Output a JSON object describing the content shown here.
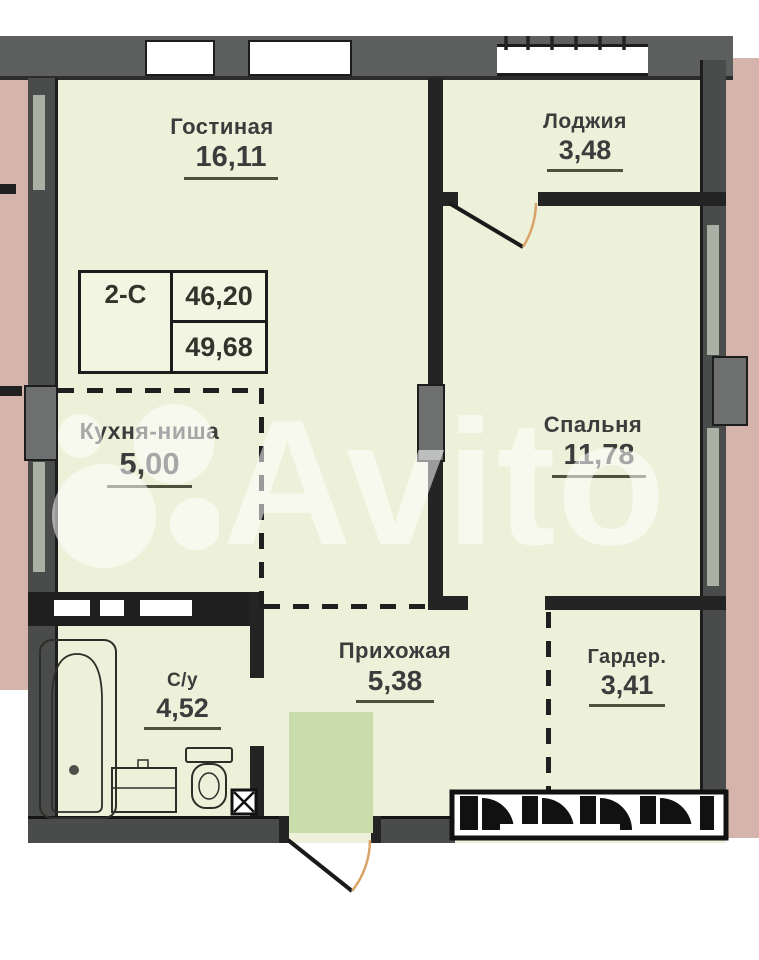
{
  "plan": {
    "watermark_text": "Avito",
    "info_box": {
      "layout_type": "2-С",
      "area_1": "46,20",
      "area_2": "49,68"
    },
    "rooms": {
      "living": {
        "name": "Гостиная",
        "area": "16,11"
      },
      "loggia": {
        "name": "Лоджия",
        "area": "3,48"
      },
      "kitchen": {
        "name": "Кухня-ниша",
        "area": "5,00"
      },
      "bedroom": {
        "name": "Спальня",
        "area": "11,78"
      },
      "hallway": {
        "name": "Прихожая",
        "area": "5,38"
      },
      "wardrobe": {
        "name": "Гардер.",
        "area": "3,41"
      },
      "bathroom": {
        "name": "С/у",
        "area": "4,52"
      }
    },
    "colors": {
      "background": "#ffffff",
      "room_fill": "#eef1da",
      "wall_gray": "#5d5e5e",
      "wall_dark": "#242424",
      "adjacent_pink": "#d5b4ac",
      "entrance_highlight": "#c9dcab",
      "door_swing": "#d9a468",
      "label_text": "#3c3c3c"
    }
  }
}
